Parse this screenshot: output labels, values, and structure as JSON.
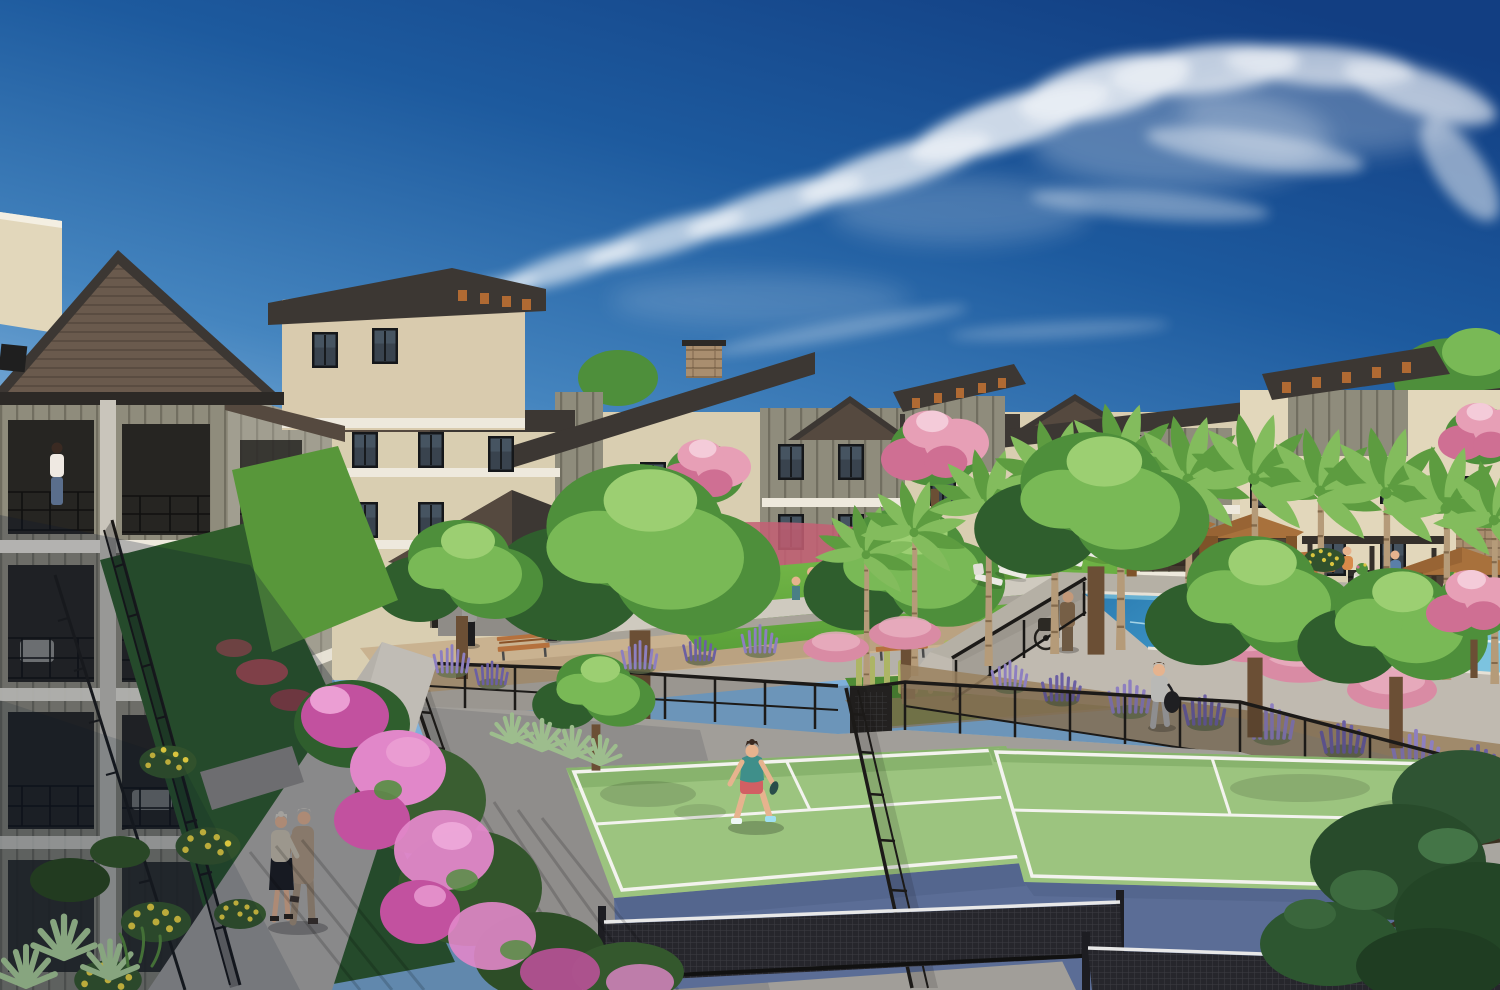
{
  "scene": {
    "type": "architectural-rendering",
    "description": "Aerial daytime rendering of an apartment community courtyard: two fenced pickleball courts with green playing surfaces and blue runoffs in the foreground, a landscaped courtyard with gazebo and lawn, a lap pool with brown cabanas and palm trees on the right, and three-story tan and gray residential buildings under a deep blue sky with wispy cirrus clouds.",
    "sky": "clear blue with cirrus streaks",
    "lighting": "bright sun from upper left, building shadow across lower-left corner"
  },
  "palette": {
    "sky_top": "#123e82",
    "sky_upper": "#1d5a9e",
    "sky_mid": "#4585bf",
    "sky_low": "#7fb0da",
    "sky_horizon": "#a9cdea",
    "cloud": "#ffffff",
    "roof_dark": "#3c3733",
    "roof_mid": "#55493f",
    "roof_lit": "#6e6053",
    "roof_shingle": "#6a5a4d",
    "fascia": "#2c2926",
    "wall_cream": "#e2d7bb",
    "wall_cream_shade": "#cfc2a4",
    "wall_tan": "#d9cbae",
    "wall_olive": "#8f8c7c",
    "wall_olive_dark": "#6e6b5e",
    "trim_white": "#eee9dd",
    "trim_shade": "#c7c2b6",
    "stone": "#a98e6f",
    "corbel": "#b06a33",
    "window_glass": "#39434e",
    "window_glass_dark": "#23282e",
    "window_frame": "#15171a",
    "lawn_bright": "#6cb043",
    "lawn": "#58973a",
    "lawn_dark": "#2f5c2b",
    "grass_strip": "#4f8c36",
    "tree_dark": "#2f5e2d",
    "tree_mid": "#4e8f3b",
    "tree_light": "#79b956",
    "tree_pale": "#9ccf72",
    "palm_trunk": "#b59b79",
    "palm_frond": "#5d9c40",
    "palm_frond_light": "#83bc5d",
    "pink_bloom": "#e79fb6",
    "pink_deep": "#cf6f93",
    "magenta_bloom": "#c2519f",
    "magenta_light": "#e187c9",
    "muhly_pink": "#d98ba4",
    "muhly_red": "#c45f74",
    "sage_purple": "#8d7fc0",
    "sage_dark": "#6b5fa3",
    "flower_yellow": "#d9c43e",
    "agave": "#9dbd8d",
    "cactus": "#adb565",
    "cactus_dark": "#8a9a4e",
    "court_green": "#9cc47f",
    "court_green_shade": "#88b36d",
    "court_blue": "#5b6d96",
    "court_blue_dark": "#4e5f85",
    "court_line": "#f3f3ee",
    "apron": "#a19e99",
    "apron_lit": "#b1aea8",
    "apron_dark": "#8b8884",
    "fence": "#1c1a18",
    "net_dark": "#26262c",
    "net_tape": "#e8e8e8",
    "pool_water": "#3f98c8",
    "pool_deep": "#2a7ab0",
    "pool_light": "#7cc3df",
    "coping": "#e6e1d6",
    "deck": "#c0bab0",
    "deck_shade": "#a9a399",
    "cabana": "#a8713c",
    "cabana_dark": "#7e5329",
    "cabana_interior": "#3a2f24",
    "bench_wood": "#b5713d",
    "bench_dark": "#8a5227",
    "path_lit": "#b5b1aa",
    "path_shade": "#8f8c87",
    "gravel": "#c9b290",
    "gravel_dark": "#ab9271",
    "soil": "#9a815f",
    "skin": "#e6b38e"
  },
  "objects": {
    "buildings": {
      "stories": 3,
      "styles": "cream stucco and olive board-and-batten, dark gable and shed roofs, towers with orange corbels",
      "balcony_railings": "black metal"
    },
    "pickleball_courts": {
      "count": 2,
      "surface": "green",
      "runoff": "blue",
      "lines": "white",
      "nets": 2,
      "fencing": "black steel mesh"
    },
    "pool": {
      "type": "lap pool",
      "water": "blue",
      "loungers": 6,
      "cabanas": 3,
      "planter_urns": 2
    },
    "palm_trees": {
      "count": 11
    },
    "gazebo": {
      "roof": "dark pyramidal",
      "pillar": "stacked stone"
    },
    "benches": {
      "count": 4,
      "material": "wood slat"
    },
    "plants": [
      "pink bougainvillea",
      "purple sage",
      "pink muhly grass",
      "yellow flowering shrubs",
      "agave",
      "columnar cacti",
      "pink flowering trees"
    ],
    "people": [
      {
        "where": "left walkway",
        "desc": "elderly couple walking arm in arm"
      },
      {
        "where": "near court",
        "desc": "woman in teal top and coral shorts in ready stance"
      },
      {
        "where": "far court",
        "desc": "woman in gray activewear carrying duffel bag"
      },
      {
        "where": "left balcony",
        "desc": "woman standing at railing"
      },
      {
        "where": "courtyard",
        "desc": "several residents standing and children on lawn"
      },
      {
        "where": "pool deck",
        "desc": "man beside wheelchair, two people seated at pool edge"
      }
    ]
  }
}
